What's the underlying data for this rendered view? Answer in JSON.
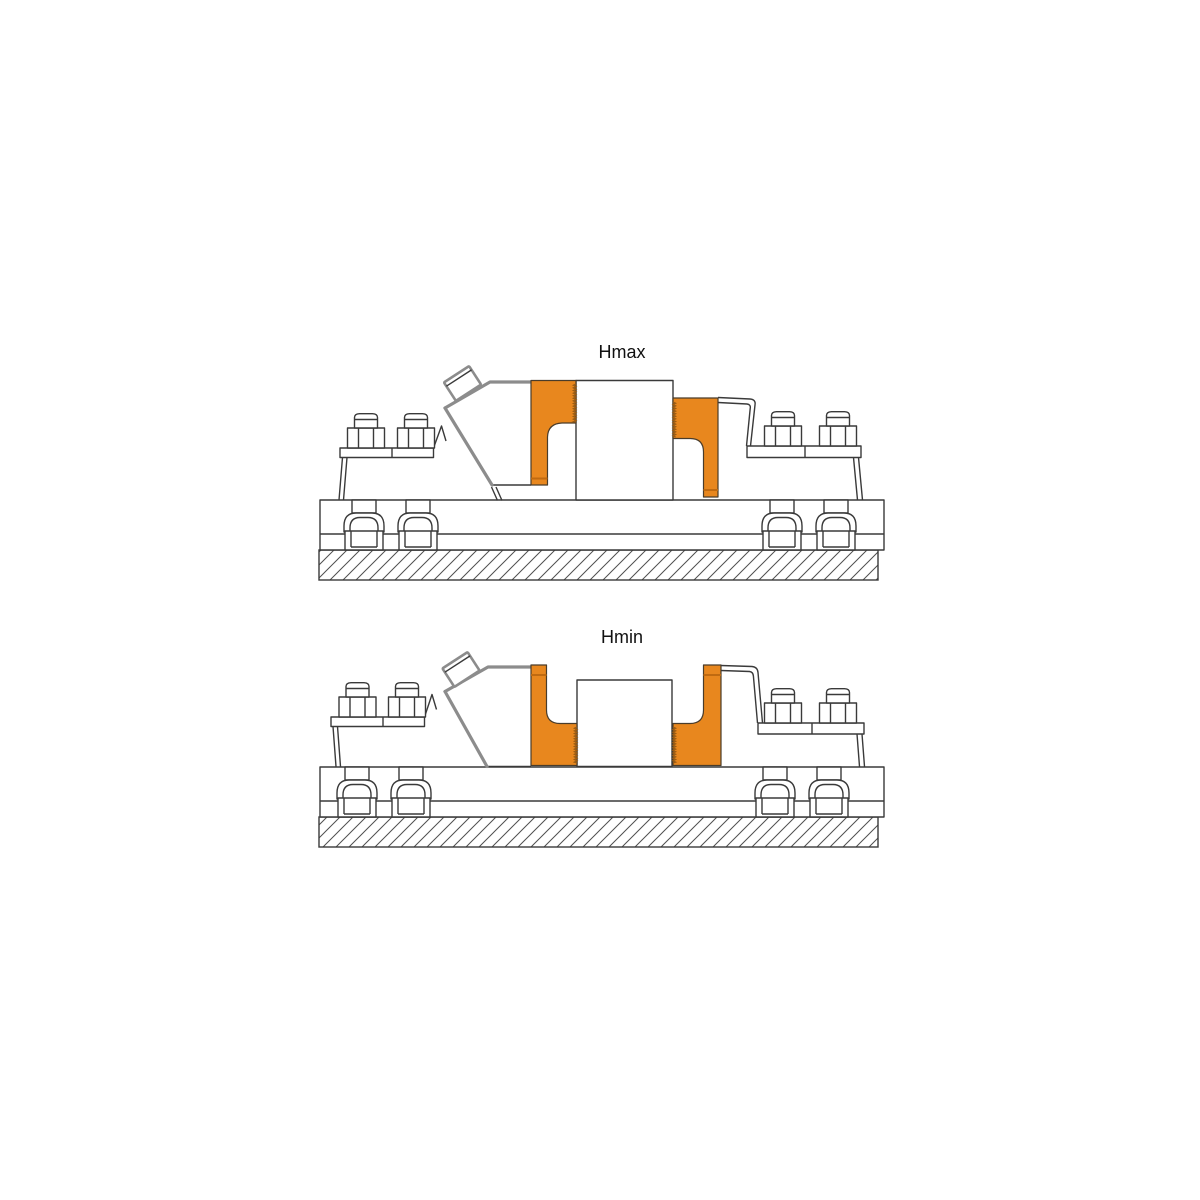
{
  "page": {
    "background": "#ffffff"
  },
  "colors": {
    "page_bg": "#ffffff",
    "accent": "#E8871E",
    "accent_dark": "#C06A10",
    "accent_serr": "#9A5C14",
    "accent_edge": "#4a3c2a",
    "line": "#3a3a3a",
    "line_heavy": "#8c8c8c",
    "hatch_line": "#4f4f4f",
    "label": "#111111"
  },
  "figures": [
    {
      "id": "hmax",
      "label": "Hmax"
    },
    {
      "id": "hmin",
      "label": "Hmin"
    }
  ]
}
